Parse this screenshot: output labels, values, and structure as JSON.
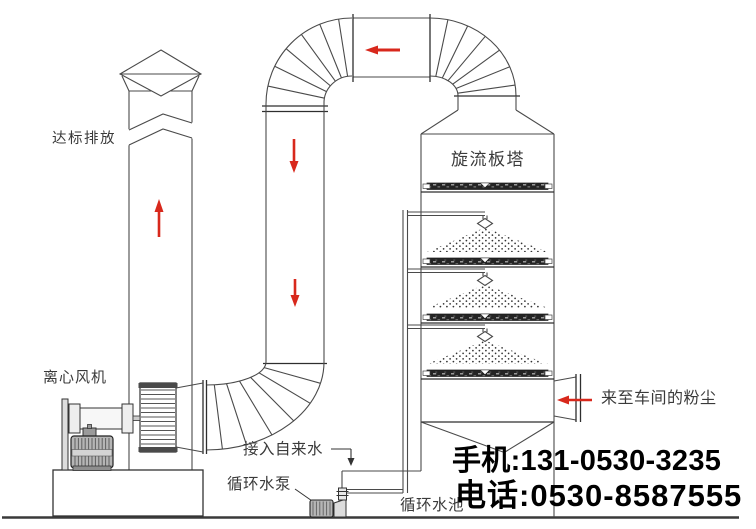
{
  "labels": {
    "emission": "达标排放",
    "fan": "离心风机",
    "tower": "旋流板塔",
    "dust_inlet": "来至车间的粉尘",
    "tap_water": "接入自来水",
    "pump": "循环水泵",
    "pool": "循环水池"
  },
  "contact": {
    "mobile": "手机:131-0530-3235",
    "phone": "电话:0530-8587555"
  },
  "colors": {
    "line": "#4a4a4a",
    "flow_arrow": "#d8281c",
    "label_text": "#3a3a3a",
    "contact_text": "#000000",
    "background": "#ffffff"
  },
  "flow_arrows": [
    {
      "name": "stack-up-arrow",
      "direction": "up"
    },
    {
      "name": "top-duct-left-arrow",
      "direction": "left"
    },
    {
      "name": "downcomer-arrow-1",
      "direction": "down"
    },
    {
      "name": "downcomer-arrow-2",
      "direction": "down"
    },
    {
      "name": "inlet-left-arrow",
      "direction": "left"
    }
  ]
}
